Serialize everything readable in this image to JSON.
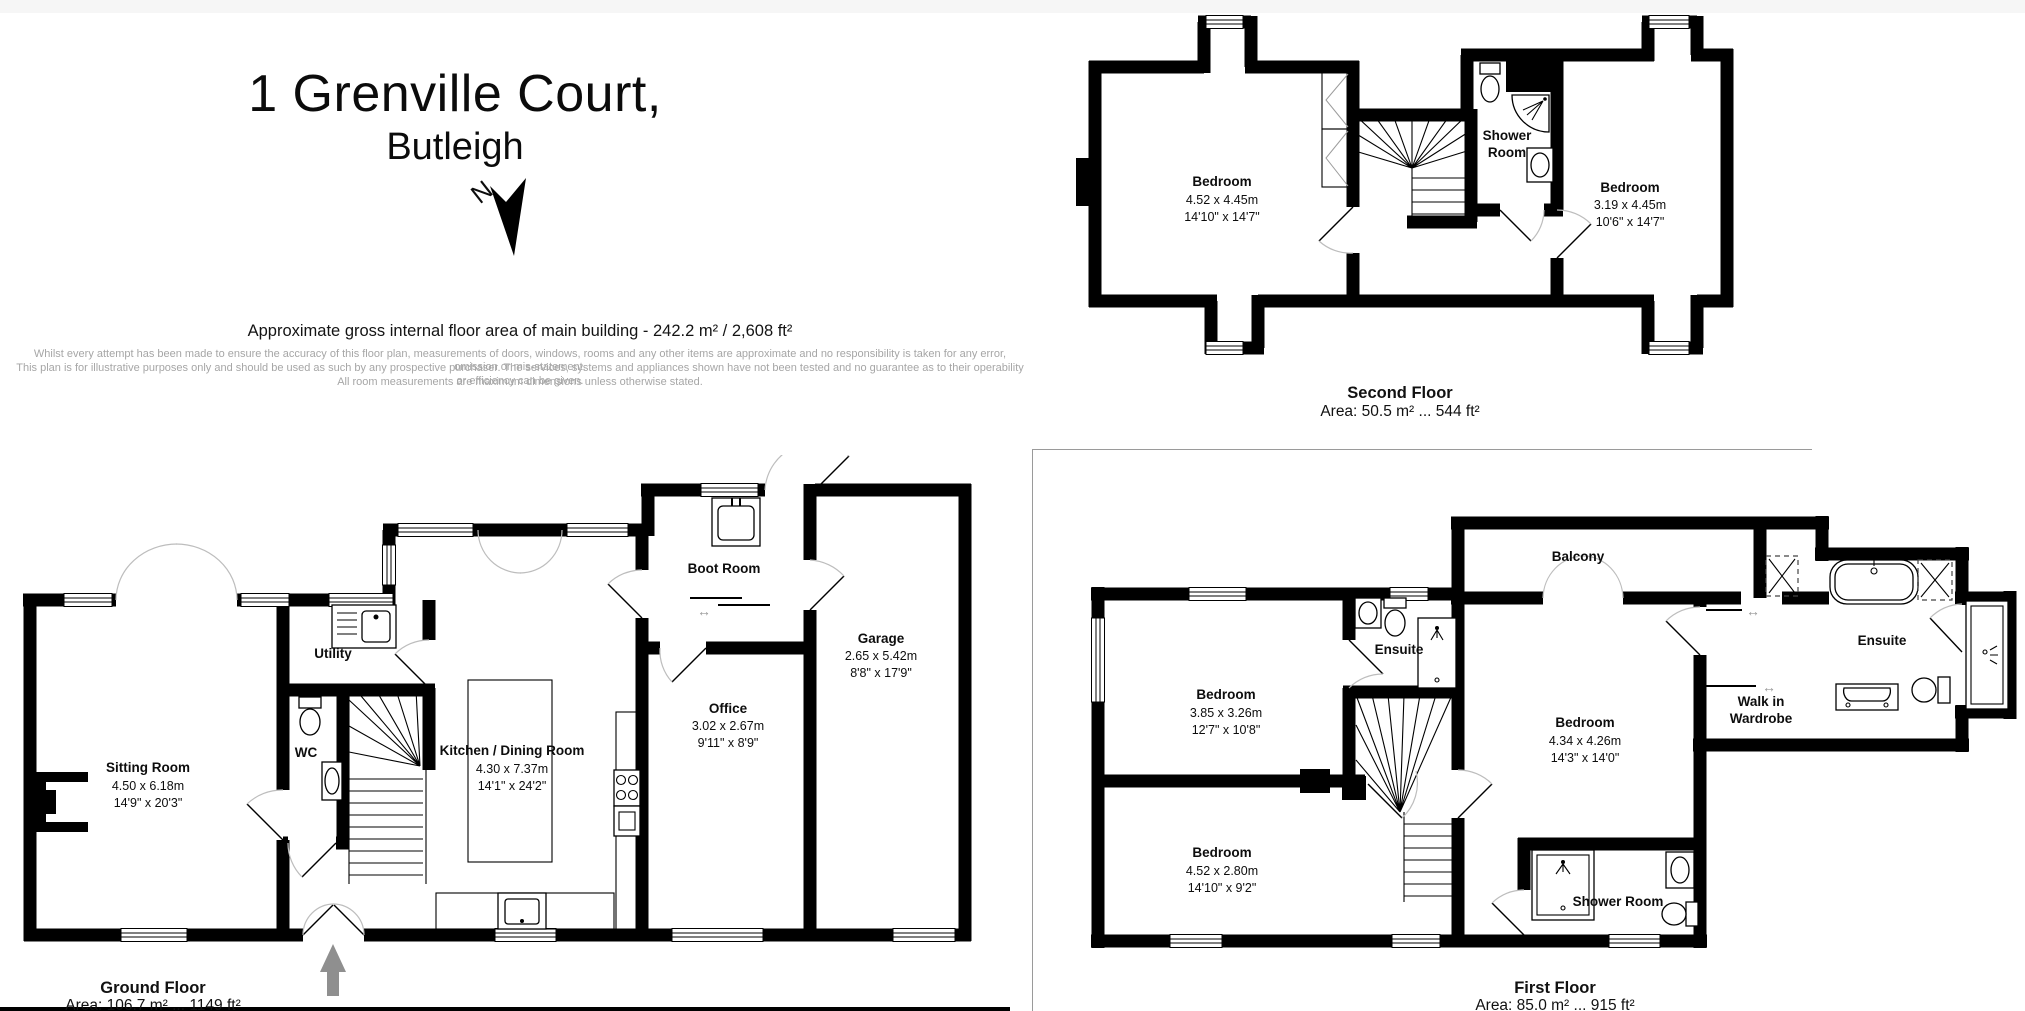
{
  "header": {
    "title_line1": "1 Grenville Court,",
    "title_line2": "Butleigh",
    "north_label": "N",
    "area_summary": "Approximate gross internal floor area of main building  -  242.2 m² /  2,608 ft²",
    "disclaimer_line1": "Whilst every attempt has been made to ensure the accuracy of this floor plan, measurements of doors, windows, rooms and any other items are approximate and no responsibility is taken for any error, omission or mis-statement.",
    "disclaimer_line2": "This plan is for illustrative purposes only and should be used as such by any prospective purchaser. The services, systems and appliances shown have not been tested and no guarantee as to their operability or efficiency can be given.",
    "disclaimer_line3": "All room measurements are maximum dimensions unless otherwise stated."
  },
  "floors": {
    "ground": {
      "title": "Ground Floor",
      "area": "Area: 106.7 m² ... 1149 ft²",
      "sitting": {
        "name": "Sitting Room",
        "m": "4.50 x 6.18m",
        "ft": "14'9\" x 20'3\""
      },
      "utility": {
        "name": "Utility"
      },
      "wc": {
        "name": "WC"
      },
      "kitchen": {
        "name": "Kitchen / Dining Room",
        "m": "4.30 x 7.37m",
        "ft": "14'1\" x 24'2\""
      },
      "boot": {
        "name": "Boot Room"
      },
      "office": {
        "name": "Office",
        "m": "3.02 x 2.67m",
        "ft": "9'11\" x 8'9\""
      },
      "garage": {
        "name": "Garage",
        "m": "2.65 x 5.42m",
        "ft": "8'8\" x 17'9\""
      }
    },
    "first": {
      "title": "First Floor",
      "area": "Area: 85.0 m² ... 915 ft²",
      "bedroom1": {
        "name": "Bedroom",
        "m": "3.85 x 3.26m",
        "ft": "12'7\" x 10'8\""
      },
      "ensuite1": {
        "name": "Ensuite"
      },
      "balcony": {
        "name": "Balcony"
      },
      "bedroom2": {
        "name": "Bedroom",
        "m": "4.34 x 4.26m",
        "ft": "14'3\" x 14'0\""
      },
      "wardrobe": {
        "line1": "Walk in",
        "line2": "Wardrobe"
      },
      "ensuite2": {
        "name": "Ensuite"
      },
      "bedroom3": {
        "name": "Bedroom",
        "m": "4.52 x 2.80m",
        "ft": "14'10\" x 9'2\""
      },
      "shower": {
        "name": "Shower Room"
      }
    },
    "second": {
      "title": "Second Floor",
      "area": "Area: 50.5 m² ... 544 ft²",
      "bedroom1": {
        "name": "Bedroom",
        "m": "4.52 x 4.45m",
        "ft": "14'10\" x 14'7\""
      },
      "shower": {
        "line1": "Shower",
        "line2": "Room"
      },
      "bedroom2": {
        "name": "Bedroom",
        "m": "3.19 x 4.45m",
        "ft": "10'6\" x 14'7\""
      }
    }
  }
}
